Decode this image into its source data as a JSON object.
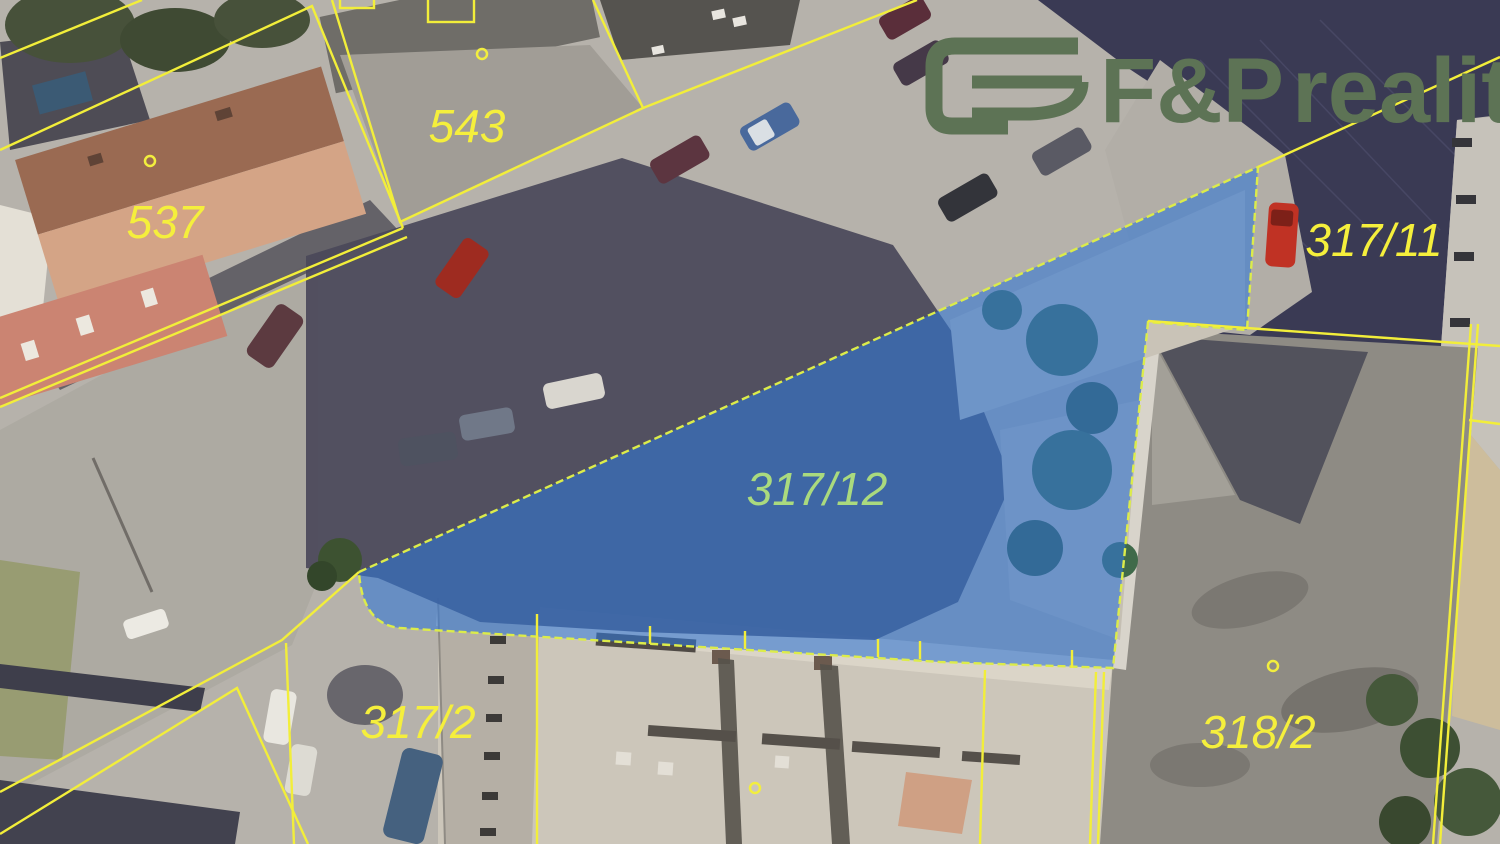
{
  "map": {
    "type": "aerial-cadastral",
    "highlighted_parcel": "317/12",
    "parcels": {
      "p543": "543",
      "p537": "537",
      "p317_11": "317/11",
      "p317_12": "317/12",
      "p317_2": "317/2",
      "p318_2": "318/2"
    }
  },
  "logo": {
    "brand": "F&P",
    "suffix": "reality"
  },
  "colors": {
    "boundary_yellow": "#f2ee3a",
    "boundary_dashed": "#dcec4a",
    "highlight_blue": "#3277d4",
    "label_yellow": "#f5ef3c",
    "highlight_label_green": "#aada7e",
    "logo_green": "#5d7355"
  }
}
